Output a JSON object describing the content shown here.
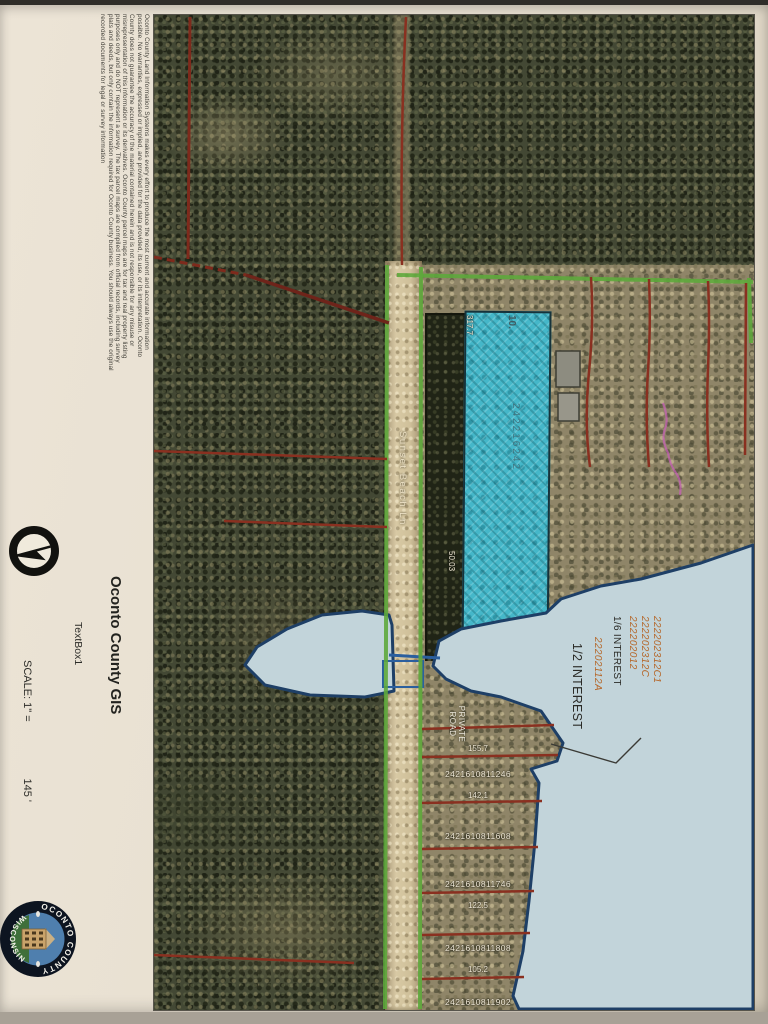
{
  "sidebar": {
    "disclaimer": "Oconto County Land Information Systems makes every effort to produce the most current and accurate information possible. No warranties, expressed or implied, are provided for the data provided, its use, or its interpretation. Oconto County does not guarantee the accuracy of the material contained herein and is not responsible for any misuse or misrepresentation of this information or its derivatives. Oconto County parcel maps are for tax and real property listing purposes only and do NOT represent a survey. The tax parcel maps are compiled from official records, including survey plats and deeds, but only contain the information required for Oconto County business. You should always use the original recorded documents for legal or survey information",
    "title": "Oconto County GIS",
    "textbox_label": "TextBox1",
    "scale_label": "SCALE: 1\" =",
    "scale_value": "145 '",
    "seal": {
      "arc_top": "OCONTO COUNTY",
      "arc_bottom": "WISCONSIN"
    }
  },
  "map": {
    "road_name": "Sunset Beach Ln",
    "private_road_label": "PRIVATE ROAD",
    "highlight": {
      "lot_number": "10.",
      "parcel_id": "242216242",
      "width_top": "317.7",
      "width_side": "50.03"
    },
    "lake_annotations": {
      "parcel_ids": [
        "222202312C1",
        "222202312C",
        "222202012"
      ],
      "interest_1": "1/6 INTEREST",
      "parcel_id_2": "22202112A",
      "interest_2": "1/2 INTEREST"
    },
    "road_lots": [
      {
        "text": "155.7"
      },
      {
        "text": "2421610811246"
      },
      {
        "text": "142.1"
      },
      {
        "text": "2421610811608"
      },
      {
        "text": "2421610811746"
      },
      {
        "text": "122.5"
      },
      {
        "text": "2421610811808"
      },
      {
        "text": "105.2"
      },
      {
        "text": "2421610811902"
      }
    ],
    "colors": {
      "highlight_fill": "#45b7c9",
      "boundary_green": "#5ea83c",
      "parcel_red": "#8a3020",
      "water_fill": "#c2d4da",
      "water_outline": "#1e3f66",
      "annotation_orange": "#b5672a"
    }
  }
}
